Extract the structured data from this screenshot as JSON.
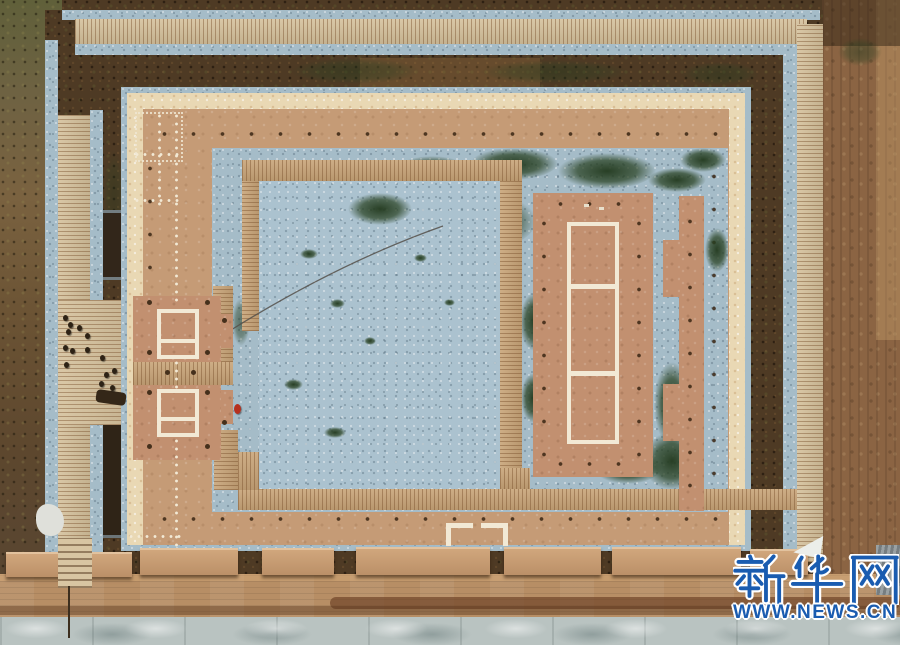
{
  "scene": {
    "description": "Aerial drone photograph of an excavated ancient palace foundation site: wooden visitor boardwalks, blue-gray gravel-covered excavation courtyards, rammed-earth platforms with white foundation outline markers, visitors on the west walkway, a dirt road along the south side"
  },
  "watermark": {
    "brand": "新华网",
    "url": "WWW.NEWS.CN"
  },
  "palette": {
    "field-right": "#8b6443",
    "soil-dark": "#4e3a24",
    "gravel": "#a5bcc8",
    "wood": "#c8a478",
    "platform-tan": "#c59b76",
    "cream-walkway": "#e9d8b4",
    "white-marker": "#f2e9d5",
    "moss-green": "#2d4527",
    "road": "#b78e65",
    "concrete": "#b9c3c1",
    "post-hole": "#45301c",
    "red-figure": "#b5301f",
    "wm-blue": "#1a5cb0"
  }
}
